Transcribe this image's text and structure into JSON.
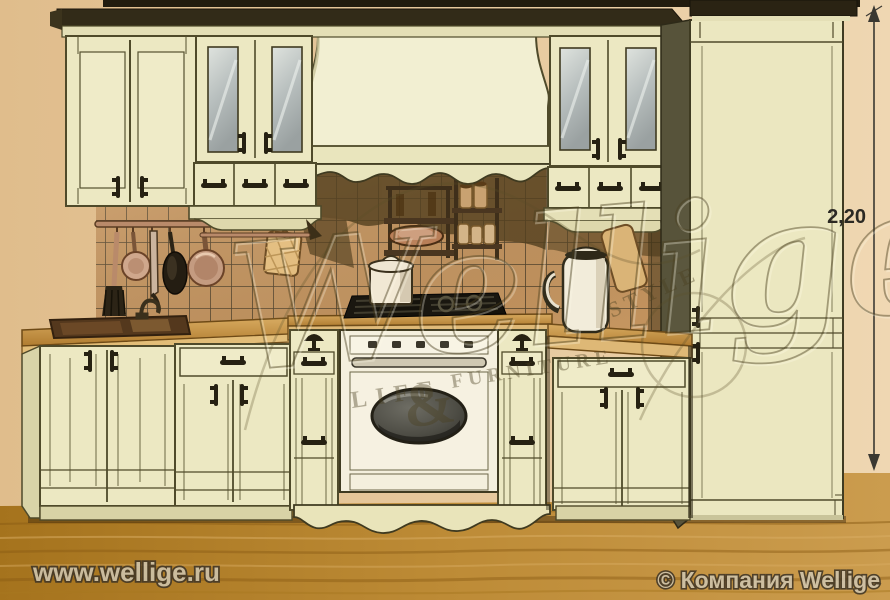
{
  "watermark": {
    "brand": "Wellige",
    "life": "LIFE",
    "ampersand": "&",
    "furniture": "FURNITURE",
    "style": "STYLE"
  },
  "dimension": {
    "height_label": "2,20"
  },
  "footer": {
    "website": "www.wellige.ru",
    "copyright": "© Компания Wellige"
  },
  "palette": {
    "wall": "#e6c79c",
    "floor": "#bc8a35",
    "floor_dark": "#96691a",
    "cabinet_cream": "#ece8c2",
    "cabinet_light": "#f2efd2",
    "cabinet_shade": "#d9d4a8",
    "outline_olive": "#4f4a2a",
    "cornice_dark": "#322b18",
    "tile": "#c6955f",
    "tile_grid": "#3a3220",
    "counter_wood": "#c89750",
    "counter_edge": "#e2bd78",
    "copper": "#c49a7e",
    "appliance_white": "#f4efdd",
    "oven_glass": "#4e4d45",
    "handle_dark": "#262112",
    "text_light": "#cfc5ae",
    "text_outline": "#3f3526"
  }
}
